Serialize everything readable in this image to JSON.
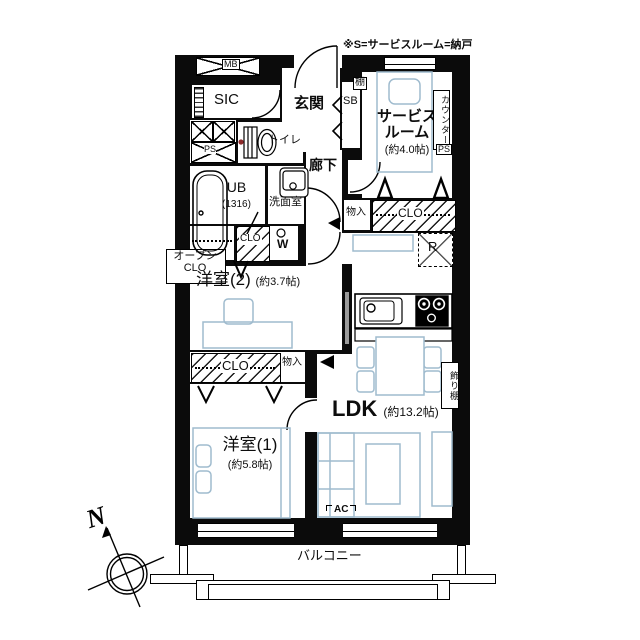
{
  "title": "マンション間取り図",
  "note": "※S=サービスルーム=納戸",
  "colors": {
    "wall": "#0b0b0b",
    "furniture": "#9fbbce",
    "alert_dot": "#8e2b2b"
  },
  "labels": {
    "mb": "MB",
    "sic": "SIC",
    "genkan": "玄関",
    "sb": "SB",
    "shelf": "棚",
    "service_room_l1": "サービス",
    "service_room_l2": "ルーム",
    "service_room_size": "(約4.0帖)",
    "counter": "カウンター",
    "ps_right": "PS",
    "ps_left": "PS",
    "toilet": "トイレ",
    "corridor": "廊下",
    "ub": "UB",
    "ub_size": "(1316)",
    "washroom": "洗面室",
    "storage_right": "物入",
    "closet_right": "CLO",
    "fridge": "R",
    "open_closet_l1": "オープン",
    "open_closet_l2": "CLO",
    "closet_small": "CLO",
    "washer": "W",
    "bedroom2": "洋室(2)",
    "bedroom2_size": "(約3.7帖)",
    "closet_mid": "CLO",
    "storage_mid": "物入",
    "bedroom1": "洋室(1)",
    "bedroom1_size": "(約5.8帖)",
    "ldk": "LDK",
    "ldk_size": "(約13.2帖)",
    "display_shelf": "飾り棚",
    "ac": "AC",
    "balcony": "バルコニー",
    "north": "N"
  }
}
